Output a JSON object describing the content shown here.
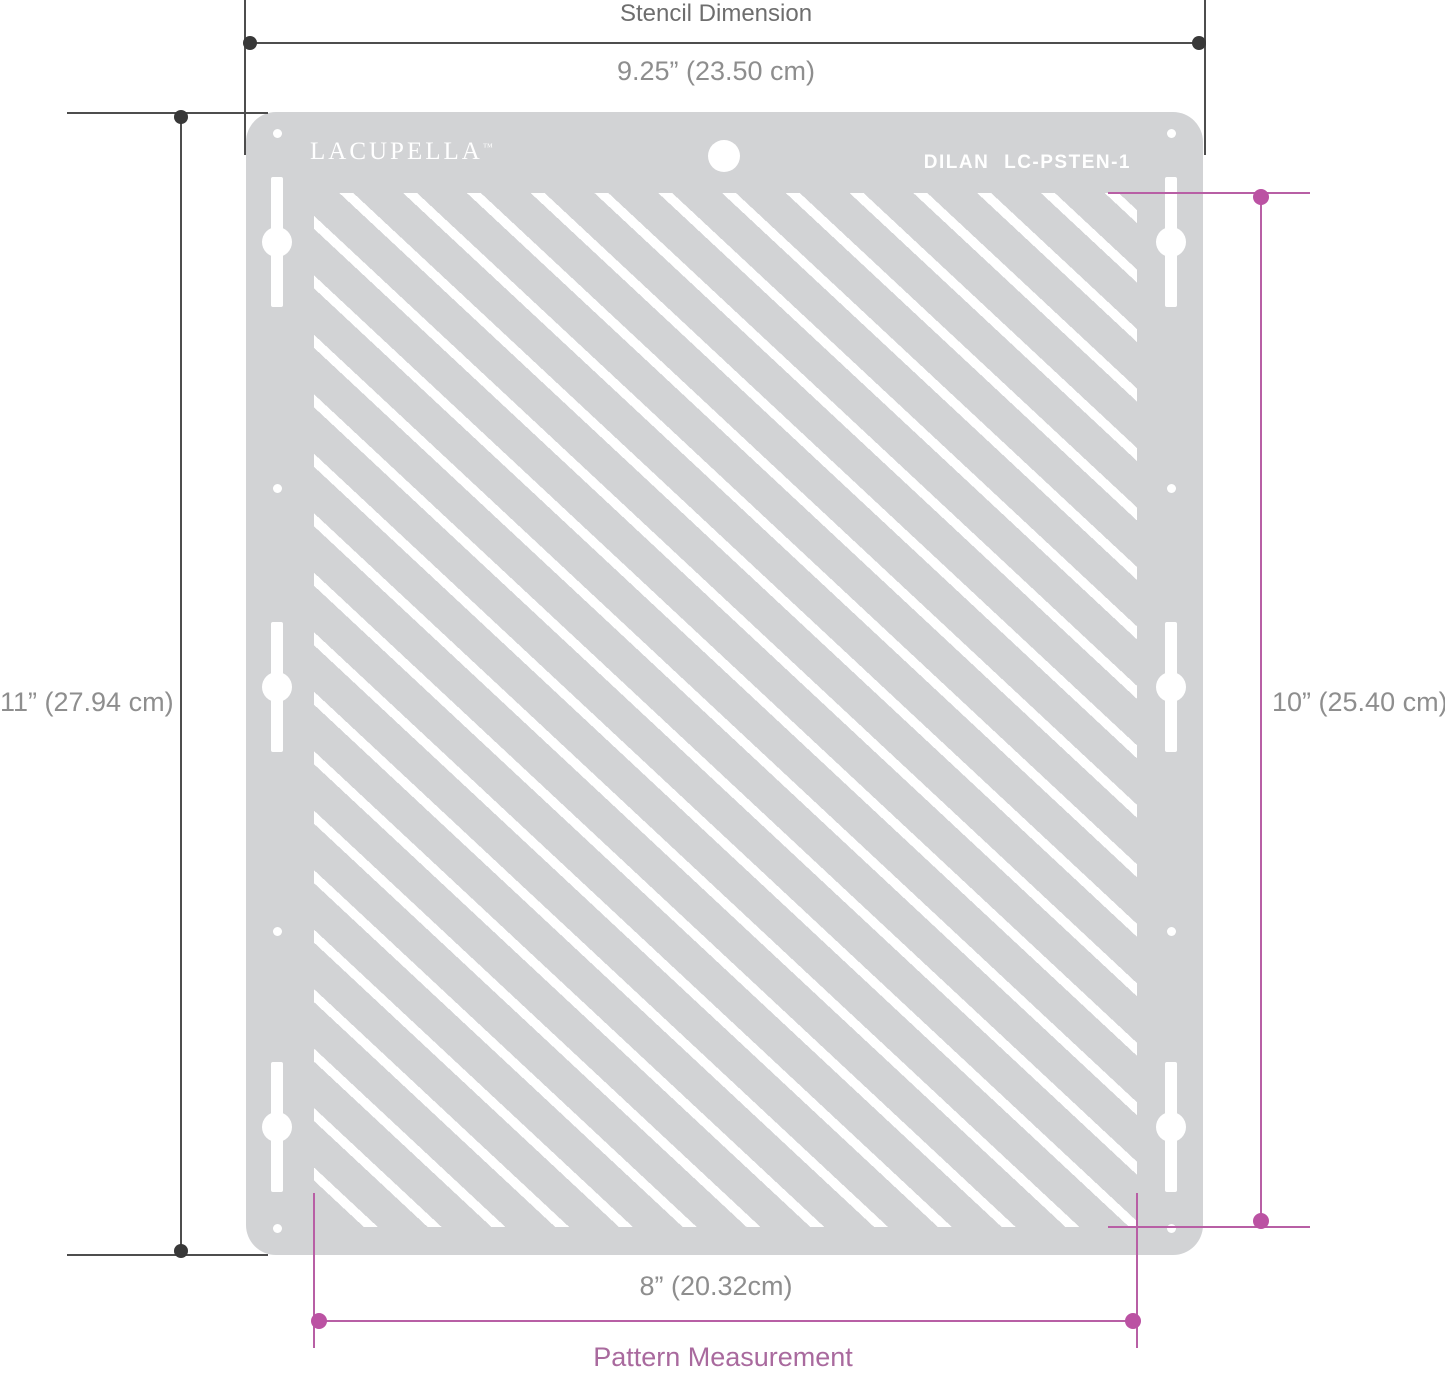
{
  "diagram": {
    "top_dimension": {
      "label": "Stencil Dimension",
      "value": "9.25” (23.50 cm)"
    },
    "left_dimension": {
      "value": "11” (27.94 cm)"
    },
    "right_dimension": {
      "value": "10” (25.40 cm)"
    },
    "bottom_dimension": {
      "value": "8” (20.32cm)",
      "label": "Pattern Measurement"
    }
  },
  "stencil": {
    "brand": "LACUPELLA",
    "brand_trademark": "™",
    "model": "DILAN LC-PSTEN-1"
  },
  "colors": {
    "sheet_gray": "#d2d3d5",
    "stripe_white": "#ffffff",
    "dimension_dark": "#4d4d4d",
    "dimension_pink": "#b85fa5",
    "value_text_gray": "#8e8e8e",
    "title_text_gray": "#6e6e6e",
    "pattern_label_pink": "#a96a9e"
  }
}
